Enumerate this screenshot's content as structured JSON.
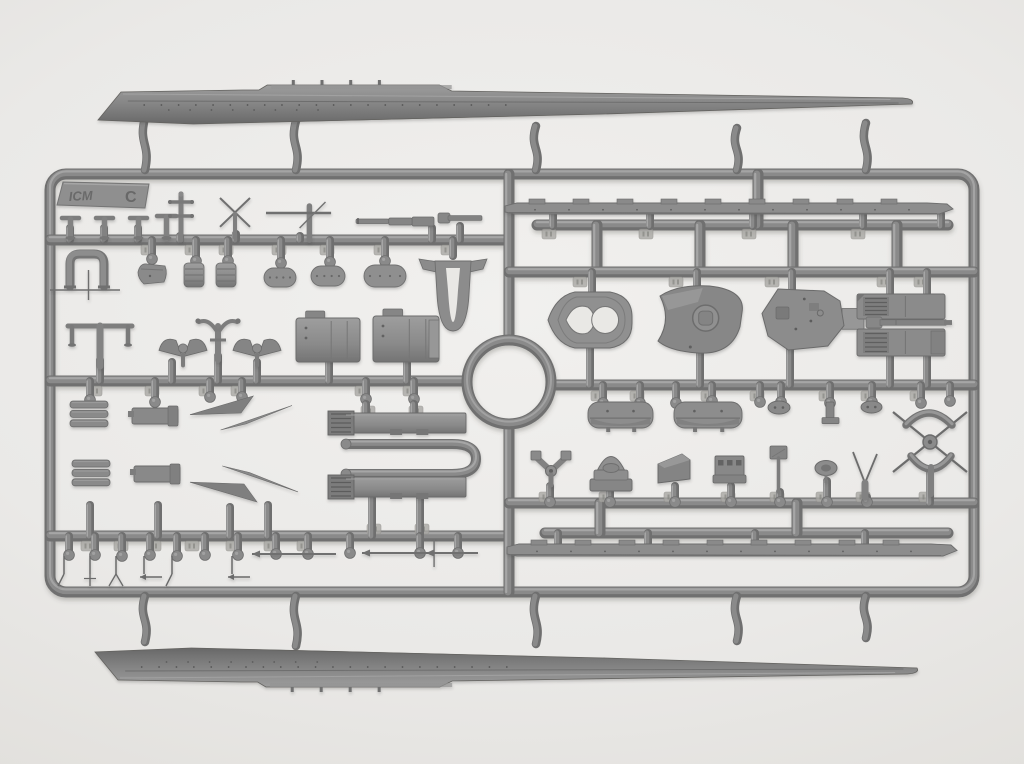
{
  "scene": {
    "w": 1024,
    "h": 764,
    "bg_center": "#f1f0ee",
    "bg_edge": "#d2d0cd",
    "plastic": {
      "hi": "#a6a6a6",
      "mid": "#8a8a8a",
      "base": "#6f6f6f",
      "line": "#5e5e5e",
      "tag": "#a9a8a4",
      "cut": "#e9e8e5"
    }
  },
  "logo": {
    "brand": "ICM",
    "sprue_letter": "C"
  },
  "frame": {
    "x": 50,
    "y": 174,
    "w": 924,
    "h": 418,
    "rx": 16,
    "tube": 11
  },
  "ring": {
    "cx": 509,
    "cy": 382,
    "r": 42,
    "tube": 11
  },
  "runners": [
    [
      50,
      240,
      509,
      240
    ],
    [
      50,
      381,
      467,
      381
    ],
    [
      50,
      536,
      509,
      536
    ],
    [
      509,
      174,
      509,
      340
    ],
    [
      509,
      424,
      509,
      592
    ],
    [
      537,
      225,
      948,
      225
    ],
    [
      597,
      225,
      597,
      272
    ],
    [
      700,
      225,
      700,
      272
    ],
    [
      793,
      225,
      793,
      272
    ],
    [
      897,
      225,
      897,
      272
    ],
    [
      758,
      174,
      758,
      225
    ],
    [
      509,
      272,
      974,
      272
    ],
    [
      551,
      385,
      974,
      385
    ],
    [
      509,
      503,
      974,
      503
    ],
    [
      545,
      533,
      948,
      533
    ],
    [
      600,
      503,
      600,
      533
    ],
    [
      797,
      503,
      797,
      533
    ]
  ],
  "hull_gates_top": [
    [
      145,
      118,
      170
    ],
    [
      296,
      121,
      170
    ],
    [
      536,
      126,
      170
    ],
    [
      737,
      128,
      170
    ],
    [
      866,
      123,
      170
    ]
  ],
  "hull_gates_bottom": [
    [
      145,
      596,
      642
    ],
    [
      296,
      596,
      646
    ],
    [
      536,
      596,
      644
    ],
    [
      737,
      596,
      641
    ],
    [
      866,
      596,
      638
    ]
  ],
  "gates": [
    [
      553,
      214,
      226,
      0
    ],
    [
      650,
      214,
      226,
      0
    ],
    [
      753,
      214,
      226,
      0
    ],
    [
      863,
      214,
      226,
      0
    ],
    [
      941,
      214,
      226,
      0
    ],
    [
      592,
      272,
      292,
      0
    ],
    [
      697,
      272,
      290,
      0
    ],
    [
      792,
      272,
      294,
      0
    ],
    [
      590,
      348,
      385,
      0
    ],
    [
      700,
      352,
      385,
      0
    ],
    [
      790,
      348,
      385,
      0
    ],
    [
      890,
      272,
      296,
      0
    ],
    [
      927,
      272,
      298,
      0
    ],
    [
      890,
      353,
      385,
      0
    ],
    [
      927,
      353,
      385,
      0
    ],
    [
      603,
      385,
      404,
      1
    ],
    [
      640,
      385,
      404,
      1
    ],
    [
      676,
      385,
      404,
      1
    ],
    [
      712,
      385,
      402,
      1
    ],
    [
      760,
      385,
      403,
      1
    ],
    [
      781,
      385,
      403,
      1
    ],
    [
      830,
      385,
      404,
      1
    ],
    [
      872,
      385,
      403,
      1
    ],
    [
      921,
      385,
      404,
      1
    ],
    [
      950,
      385,
      402,
      1
    ],
    [
      550,
      486,
      503,
      1
    ],
    [
      610,
      481,
      503,
      1
    ],
    [
      675,
      486,
      503,
      1
    ],
    [
      731,
      486,
      503,
      1
    ],
    [
      780,
      492,
      503,
      1
    ],
    [
      827,
      481,
      503,
      1
    ],
    [
      867,
      497,
      503,
      1
    ],
    [
      930,
      470,
      503,
      0
    ],
    [
      558,
      533,
      546,
      0
    ],
    [
      648,
      533,
      546,
      0
    ],
    [
      755,
      533,
      546,
      0
    ],
    [
      865,
      533,
      546,
      0
    ],
    [
      70,
      228,
      240,
      0
    ],
    [
      104,
      228,
      240,
      0
    ],
    [
      138,
      228,
      240,
      0
    ],
    [
      180,
      236,
      240,
      0
    ],
    [
      236,
      234,
      240,
      0
    ],
    [
      300,
      236,
      240,
      0
    ],
    [
      432,
      228,
      240,
      0
    ],
    [
      460,
      226,
      240,
      0
    ],
    [
      152,
      240,
      260,
      1
    ],
    [
      196,
      240,
      262,
      1
    ],
    [
      228,
      240,
      262,
      1
    ],
    [
      281,
      240,
      264,
      1
    ],
    [
      330,
      240,
      263,
      1
    ],
    [
      385,
      240,
      262,
      1
    ],
    [
      453,
      240,
      256,
      0
    ],
    [
      100,
      360,
      381,
      0
    ],
    [
      172,
      362,
      381,
      0
    ],
    [
      218,
      356,
      381,
      0
    ],
    [
      257,
      362,
      381,
      0
    ],
    [
      329,
      358,
      381,
      0
    ],
    [
      407,
      360,
      381,
      0
    ],
    [
      90,
      381,
      401,
      1
    ],
    [
      155,
      381,
      403,
      1
    ],
    [
      210,
      381,
      398,
      1
    ],
    [
      242,
      381,
      398,
      1
    ],
    [
      366,
      381,
      400,
      1
    ],
    [
      414,
      381,
      400,
      1
    ],
    [
      366,
      404,
      414,
      0
    ],
    [
      414,
      404,
      414,
      0
    ],
    [
      372,
      498,
      536,
      0
    ],
    [
      420,
      498,
      536,
      0
    ],
    [
      90,
      505,
      536,
      0
    ],
    [
      158,
      505,
      536,
      0
    ],
    [
      230,
      507,
      536,
      0
    ],
    [
      268,
      505,
      536,
      0
    ],
    [
      69,
      536,
      556,
      1
    ],
    [
      95,
      536,
      556,
      1
    ],
    [
      122,
      536,
      557,
      1
    ],
    [
      150,
      536,
      556,
      1
    ],
    [
      177,
      536,
      557,
      1
    ],
    [
      205,
      536,
      556,
      1
    ],
    [
      238,
      536,
      556,
      1
    ],
    [
      276,
      536,
      555,
      1
    ],
    [
      308,
      536,
      555,
      1
    ],
    [
      350,
      536,
      554,
      1
    ],
    [
      420,
      536,
      554,
      1
    ],
    [
      458,
      536,
      554,
      1
    ]
  ],
  "tags": [
    [
      148,
      245
    ],
    [
      192,
      245
    ],
    [
      226,
      245
    ],
    [
      279,
      245
    ],
    [
      327,
      245
    ],
    [
      381,
      245
    ],
    [
      448,
      245
    ],
    [
      95,
      386
    ],
    [
      152,
      386
    ],
    [
      206,
      386
    ],
    [
      238,
      386
    ],
    [
      362,
      386
    ],
    [
      410,
      386
    ],
    [
      88,
      541
    ],
    [
      121,
      541
    ],
    [
      154,
      541
    ],
    [
      192,
      541
    ],
    [
      233,
      541
    ],
    [
      271,
      541
    ],
    [
      304,
      541
    ],
    [
      598,
      391
    ],
    [
      637,
      391
    ],
    [
      708,
      391
    ],
    [
      757,
      391
    ],
    [
      826,
      391
    ],
    [
      868,
      391
    ],
    [
      917,
      391
    ],
    [
      546,
      492
    ],
    [
      606,
      492
    ],
    [
      671,
      492
    ],
    [
      728,
      492
    ],
    [
      777,
      492
    ],
    [
      823,
      492
    ],
    [
      863,
      492
    ],
    [
      926,
      492
    ],
    [
      580,
      277
    ],
    [
      676,
      277
    ],
    [
      772,
      277
    ],
    [
      884,
      277
    ],
    [
      921,
      277
    ],
    [
      549,
      229
    ],
    [
      646,
      229
    ],
    [
      749,
      229
    ],
    [
      858,
      229
    ],
    [
      368,
      406
    ],
    [
      416,
      406
    ],
    [
      374,
      524
    ],
    [
      422,
      524
    ]
  ],
  "parts": [
    {
      "name": "hull-half-top",
      "shape": "hullTop",
      "x": 95,
      "y": 84,
      "w": 820,
      "h": 44
    },
    {
      "name": "hull-half-bottom",
      "shape": "hullTop",
      "x": 92,
      "y": 638,
      "w": 828,
      "h": 50,
      "flip": 1
    },
    {
      "name": "logo-tab",
      "shape": "logoTab",
      "x": 57,
      "y": 182,
      "w": 92,
      "h": 26
    },
    {
      "name": "bollard",
      "shape": "bollard",
      "x": 62,
      "y": 214,
      "w": 17,
      "h": 24
    },
    {
      "name": "bollard",
      "shape": "bollard",
      "x": 96,
      "y": 214,
      "w": 17,
      "h": 24
    },
    {
      "name": "bollard",
      "shape": "bollard",
      "x": 130,
      "y": 214,
      "w": 17,
      "h": 24
    },
    {
      "name": "bollard",
      "shape": "bollard",
      "x": 157,
      "y": 212,
      "w": 19,
      "h": 26
    },
    {
      "name": "mast-crosstree",
      "shape": "mastCross",
      "x": 168,
      "y": 194,
      "w": 26,
      "h": 46
    },
    {
      "name": "x-mast",
      "shape": "xMast",
      "x": 220,
      "y": 198,
      "w": 30,
      "h": 40
    },
    {
      "name": "yard-mast",
      "shape": "yardMast",
      "x": 266,
      "y": 204,
      "w": 70,
      "h": 36
    },
    {
      "name": "stepped-gun-barrel",
      "shape": "steppedBarrel",
      "x": 356,
      "y": 214,
      "w": 78,
      "h": 14
    },
    {
      "name": "short-gun-barrel",
      "shape": "shortBarrel",
      "x": 438,
      "y": 212,
      "w": 44,
      "h": 12
    },
    {
      "name": "u-bracket",
      "shape": "uBracket",
      "x": 64,
      "y": 250,
      "w": 46,
      "h": 36
    },
    {
      "name": "thin-mast-cross",
      "shape": "thinCross",
      "x": 50,
      "y": 284,
      "w": 70,
      "h": 18
    },
    {
      "name": "small-boat",
      "shape": "boatSmall",
      "x": 138,
      "y": 261,
      "w": 30,
      "h": 25
    },
    {
      "name": "winch-cylinder",
      "shape": "winchCyl",
      "x": 184,
      "y": 263,
      "w": 20,
      "h": 24
    },
    {
      "name": "winch-cylinder",
      "shape": "winchCyl",
      "x": 216,
      "y": 263,
      "w": 20,
      "h": 24
    },
    {
      "name": "oval-plate",
      "shape": "ovalPlate",
      "x": 264,
      "y": 268,
      "w": 32,
      "h": 19
    },
    {
      "name": "oval-plate",
      "shape": "ovalPlate",
      "x": 311,
      "y": 266,
      "w": 34,
      "h": 20
    },
    {
      "name": "oval-plate",
      "shape": "ovalPlate",
      "x": 364,
      "y": 265,
      "w": 42,
      "h": 22
    },
    {
      "name": "bow-frame-insert",
      "shape": "uInsert",
      "x": 427,
      "y": 255,
      "w": 52,
      "h": 78
    },
    {
      "name": "boat-davit-tee",
      "shape": "davitTee",
      "x": 64,
      "y": 316,
      "w": 72,
      "h": 50
    },
    {
      "name": "horn-piece",
      "shape": "hornPiece",
      "x": 194,
      "y": 314,
      "w": 48,
      "h": 46
    },
    {
      "name": "winged-anchor",
      "shape": "wingAnchor",
      "x": 158,
      "y": 334,
      "w": 50,
      "h": 32
    },
    {
      "name": "winged-anchor",
      "shape": "wingAnchor",
      "x": 233,
      "y": 334,
      "w": 48,
      "h": 32
    },
    {
      "name": "deckhouse-block",
      "shape": "deckhouseA",
      "x": 296,
      "y": 318,
      "w": 64,
      "h": 44
    },
    {
      "name": "deckhouse-block",
      "shape": "deckhouseB",
      "x": 373,
      "y": 316,
      "w": 66,
      "h": 46
    },
    {
      "name": "grating-stack",
      "shape": "grateStack",
      "x": 70,
      "y": 401,
      "w": 38,
      "h": 28
    },
    {
      "name": "flat-plate",
      "shape": "flatPlate",
      "x": 132,
      "y": 404,
      "w": 46,
      "h": 24
    },
    {
      "name": "pennant-spar",
      "shape": "pennantBlade",
      "x": 190,
      "y": 396,
      "w": 102,
      "h": 34,
      "dir": 1
    },
    {
      "name": "grating-stack",
      "shape": "grateStack",
      "x": 72,
      "y": 460,
      "w": 38,
      "h": 28
    },
    {
      "name": "flat-plate",
      "shape": "flatPlate",
      "x": 134,
      "y": 462,
      "w": 46,
      "h": 24
    },
    {
      "name": "pennant-spar",
      "shape": "pennantBlade",
      "x": 190,
      "y": 466,
      "w": 108,
      "h": 36,
      "dir": -1
    },
    {
      "name": "deckhouse-side",
      "shape": "louverSide",
      "x": 328,
      "y": 411,
      "w": 138,
      "h": 24
    },
    {
      "name": "u-sub-runner",
      "shape": "uRunnerPart",
      "x": 330,
      "y": 438,
      "w": 152,
      "h": 42
    },
    {
      "name": "deckhouse-side",
      "shape": "louverSide",
      "x": 328,
      "y": 475,
      "w": 138,
      "h": 24
    },
    {
      "name": "needle-spar",
      "shape": "needleSpar",
      "x": 51,
      "y": 556,
      "w": 26,
      "h": 30,
      "t": 0
    },
    {
      "name": "needle-spar",
      "shape": "needleSpar",
      "x": 77,
      "y": 556,
      "w": 26,
      "h": 30,
      "t": 1
    },
    {
      "name": "needle-spar",
      "shape": "needleSpar",
      "x": 103,
      "y": 556,
      "w": 26,
      "h": 30,
      "t": 2
    },
    {
      "name": "needle-spar",
      "shape": "needleSpar",
      "x": 131,
      "y": 556,
      "w": 26,
      "h": 30,
      "t": 3
    },
    {
      "name": "needle-spar",
      "shape": "needleSpar",
      "x": 159,
      "y": 556,
      "w": 26,
      "h": 30,
      "t": 0
    },
    {
      "name": "needle-spar",
      "shape": "needleSpar",
      "x": 219,
      "y": 556,
      "w": 26,
      "h": 30,
      "t": 3
    },
    {
      "name": "thin-yard-rod",
      "shape": "thinRodH",
      "x": 252,
      "y": 550,
      "w": 84,
      "h": 8
    },
    {
      "name": "thin-yard-rod",
      "shape": "thinRodH",
      "x": 362,
      "y": 548,
      "w": 106,
      "h": 10,
      "cross": 1
    },
    {
      "name": "thin-yard-rod",
      "shape": "thinRodH",
      "x": 426,
      "y": 549,
      "w": 52,
      "h": 8
    },
    {
      "name": "deck-strip",
      "shape": "deckStrip",
      "x": 505,
      "y": 201,
      "w": 448,
      "h": 16
    },
    {
      "name": "deck-strip",
      "shape": "deckStrip",
      "x": 507,
      "y": 542,
      "w": 450,
      "h": 17
    },
    {
      "name": "fore-platform",
      "shape": "platformFore",
      "x": 548,
      "y": 288,
      "w": 84,
      "h": 64
    },
    {
      "name": "mid-platform",
      "shape": "platformMid",
      "x": 650,
      "y": 284,
      "w": 96,
      "h": 71
    },
    {
      "name": "aft-platform",
      "shape": "platformAft",
      "x": 762,
      "y": 289,
      "w": 94,
      "h": 61
    },
    {
      "name": "louvered-block",
      "shape": "louverBlock",
      "x": 857,
      "y": 294,
      "w": 88,
      "h": 25,
      "v": 1
    },
    {
      "name": "gun-barrel-long",
      "shape": "gunBarrelLong",
      "x": 866,
      "y": 317,
      "w": 86,
      "h": 11
    },
    {
      "name": "louvered-block",
      "shape": "louverBlock",
      "x": 857,
      "y": 329,
      "w": 88,
      "h": 27,
      "v": 2
    },
    {
      "name": "ships-boat",
      "shape": "shipBoat",
      "x": 588,
      "y": 402,
      "w": 65,
      "h": 26
    },
    {
      "name": "ships-boat",
      "shape": "shipBoat",
      "x": 674,
      "y": 402,
      "w": 68,
      "h": 26
    },
    {
      "name": "oval-fitting",
      "shape": "ovalBit",
      "x": 768,
      "y": 401,
      "w": 22,
      "h": 13
    },
    {
      "name": "bracket-fitting",
      "shape": "bracketBit",
      "x": 822,
      "y": 402,
      "w": 17,
      "h": 26
    },
    {
      "name": "oval-fitting",
      "shape": "ovalBit",
      "x": 861,
      "y": 401,
      "w": 21,
      "h": 12
    },
    {
      "name": "mast-x-jig",
      "shape": "xJig",
      "x": 893,
      "y": 406,
      "w": 74,
      "h": 72
    },
    {
      "name": "curved-tee",
      "shape": "curveTee",
      "x": 906,
      "y": 405,
      "w": 46,
      "h": 20,
      "flip": 0
    },
    {
      "name": "curved-tee",
      "shape": "curveTee",
      "x": 911,
      "y": 456,
      "w": 40,
      "h": 22,
      "flip": 1
    },
    {
      "name": "v-bracket",
      "shape": "vBracket",
      "x": 531,
      "y": 451,
      "w": 40,
      "h": 34
    },
    {
      "name": "turret-dome",
      "shape": "turretDome",
      "x": 590,
      "y": 447,
      "w": 42,
      "h": 45
    },
    {
      "name": "sloped-box",
      "shape": "slopedBox",
      "x": 658,
      "y": 454,
      "w": 32,
      "h": 31
    },
    {
      "name": "window-box",
      "shape": "windowBox",
      "x": 713,
      "y": 454,
      "w": 33,
      "h": 31
    },
    {
      "name": "flag-post",
      "shape": "flagPost",
      "x": 770,
      "y": 446,
      "w": 17,
      "h": 46
    },
    {
      "name": "eye-fitting",
      "shape": "eyeOval",
      "x": 814,
      "y": 461,
      "w": 24,
      "h": 18
    },
    {
      "name": "v-antenna",
      "shape": "vAntenna",
      "x": 851,
      "y": 452,
      "w": 28,
      "h": 45
    }
  ]
}
